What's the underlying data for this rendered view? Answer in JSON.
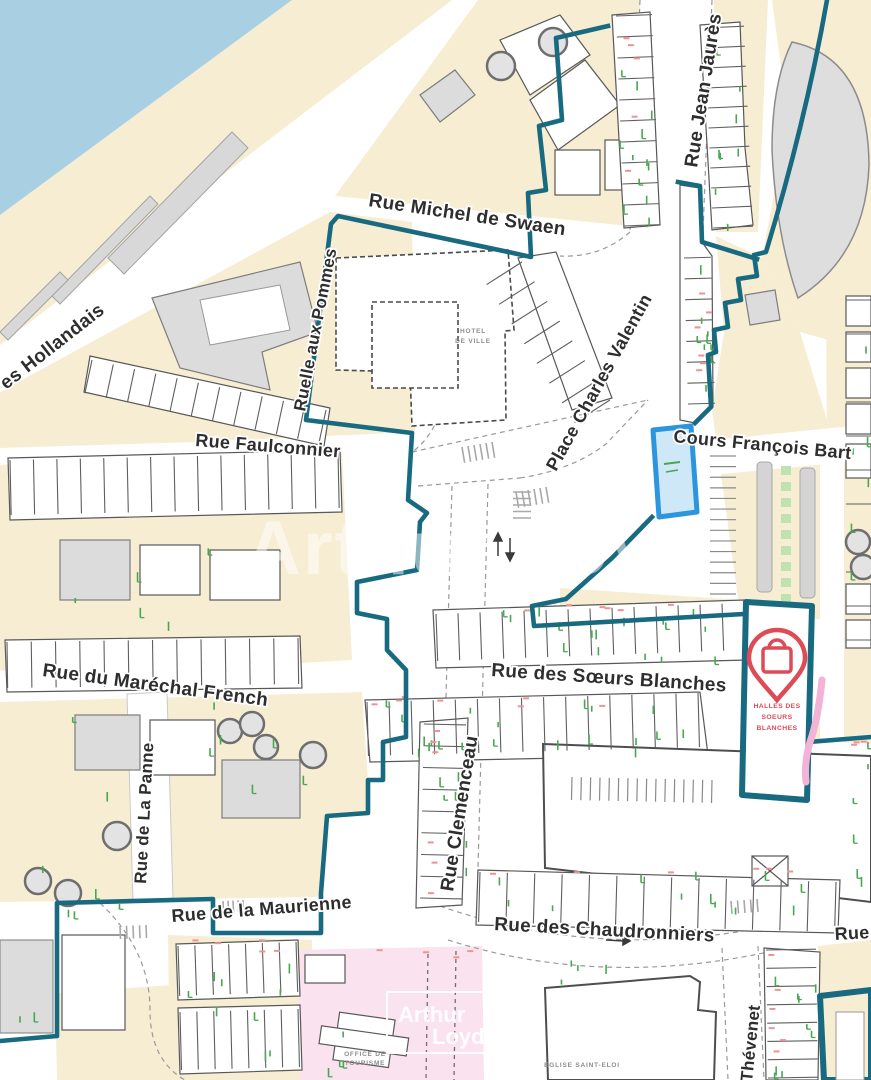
{
  "title": "City map extract with highlighted parcel",
  "streets": {
    "hollandais": {
      "label": "es Hollandais"
    },
    "swaen": {
      "label": "Rue Michel de Swaen"
    },
    "jaures": {
      "label": "Rue Jean Jaurès"
    },
    "pommes": {
      "label": "Ruelle aux Pommes"
    },
    "faulconnier": {
      "label": "Rue Faulconnier"
    },
    "valentin": {
      "label": "Place Charles Valentin"
    },
    "bart": {
      "label": "Cours François Bart"
    },
    "soeurs": {
      "label": "Rue des Sœurs Blanches"
    },
    "french": {
      "label": "Rue du Maréchal French"
    },
    "panne": {
      "label": "Rue de La Panne"
    },
    "clemenceau": {
      "label": "Rue Clemenceau"
    },
    "maurienne": {
      "label": "Rue de la Maurienne"
    },
    "chaudronniers": {
      "label": "Rue des Chaudronniers"
    },
    "thevenet": {
      "label": "Thévenet"
    },
    "rue_partial": {
      "label": "Rue"
    }
  },
  "pois": {
    "hotel_de_ville": {
      "line1": "HOTEL",
      "line2": "DE VILLE"
    },
    "halles": {
      "line1": "HALLES DES",
      "line2": "SOEURS",
      "line3": "BLANCHES",
      "icon": "shopping-bag-pin-icon"
    },
    "office_tourisme": {
      "line1": "OFFICE DE",
      "line2": "TOURISME"
    },
    "eglise": {
      "label": "EGLISE SAINT-ELOI"
    }
  },
  "watermark": {
    "center": "Arthur Loyd",
    "box_line1": "Arthur",
    "box_line2": "Loyd"
  },
  "colors": {
    "water": "#a8d0e2",
    "land": "#f6edd2",
    "boundary": "#186a80",
    "parcel-fill": "#cfe8f7",
    "parcel-stroke": "#2d95dd",
    "poi-red": "#dd4b57",
    "tick-green": "#47a84f",
    "tick-red": "#ef9292",
    "path-pink": "#f2b3d6",
    "zone-pink": "#fae3ef",
    "label": "#2e2e2e"
  }
}
